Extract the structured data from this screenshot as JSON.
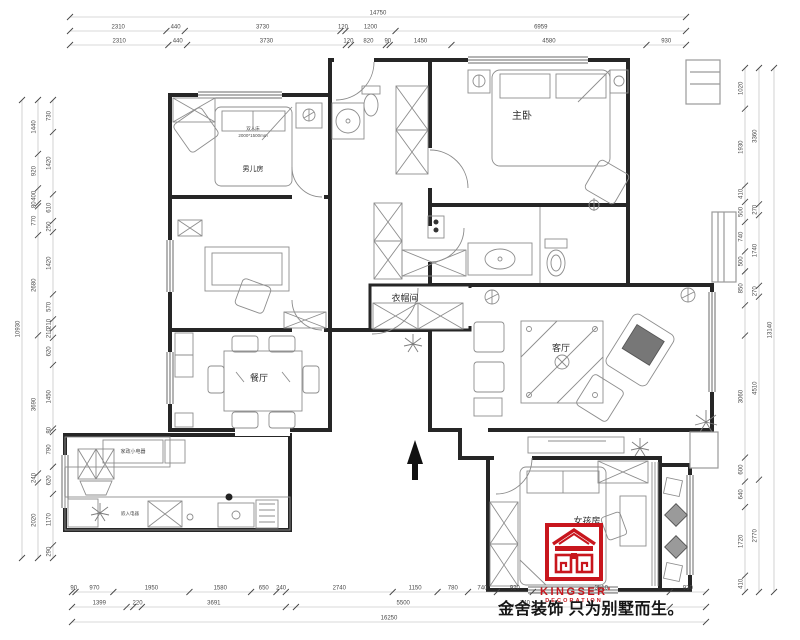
{
  "drawing_title": "apartment floor plan",
  "rooms": [
    {
      "name": "boys-room",
      "label": "男儿房",
      "x": 253,
      "y": 171,
      "size": 7
    },
    {
      "name": "master-bedroom",
      "label": "主卧",
      "x": 522,
      "y": 119,
      "size": 10
    },
    {
      "name": "cloakroom",
      "label": "衣帽间",
      "x": 405,
      "y": 301,
      "size": 9
    },
    {
      "name": "dining-room",
      "label": "餐厅",
      "x": 259,
      "y": 381,
      "size": 9
    },
    {
      "name": "living-room",
      "label": "客厅",
      "x": 561,
      "y": 351,
      "size": 9
    },
    {
      "name": "girls-room",
      "label": "女孩房",
      "x": 587,
      "y": 524,
      "size": 9
    }
  ],
  "annotations": [
    {
      "name": "bed-type-label",
      "label": "双人床",
      "x": 253,
      "y": 130,
      "size": 4.5
    },
    {
      "name": "bed-size-label",
      "label": "2000*1500mm",
      "x": 253,
      "y": 137,
      "size": 4.5
    },
    {
      "name": "kitchen-appliance-label",
      "label": "家政小电器",
      "x": 133,
      "y": 453,
      "size": 5
    },
    {
      "name": "built-in-appliance-label",
      "label": "嵌入电器",
      "x": 130,
      "y": 515,
      "size": 4.5
    }
  ],
  "dimensions": {
    "rows": [
      {
        "name": "top-total",
        "side": "top",
        "pos": 17,
        "from": 70,
        "to": 686,
        "segs": [
          [
            14750,
            "14750"
          ]
        ]
      },
      {
        "name": "top-row-2",
        "side": "top",
        "pos": 31,
        "from": 70,
        "to": 686,
        "segs": [
          [
            2310,
            "2310"
          ],
          [
            440,
            "440"
          ],
          [
            3730,
            "3730"
          ],
          [
            120,
            "120"
          ],
          [
            1200,
            "1200"
          ],
          [
            6959,
            "6959"
          ]
        ]
      },
      {
        "name": "top-row-3",
        "side": "top",
        "pos": 45,
        "from": 70,
        "to": 686,
        "segs": [
          [
            2310,
            "2310"
          ],
          [
            440,
            "440"
          ],
          [
            3730,
            "3730"
          ],
          [
            120,
            "120"
          ],
          [
            820,
            "820"
          ],
          [
            90,
            "90"
          ],
          [
            1450,
            "1450"
          ],
          [
            4580,
            "4580"
          ],
          [
            930,
            "930"
          ]
        ]
      },
      {
        "name": "bottom-row-1",
        "side": "bottom",
        "pos": 592,
        "from": 72,
        "to": 706,
        "segs": [
          [
            90,
            "90"
          ],
          [
            970,
            "970"
          ],
          [
            1950,
            "1950"
          ],
          [
            1580,
            "1580"
          ],
          [
            650,
            "650"
          ],
          [
            240,
            "240"
          ],
          [
            2740,
            "2740"
          ],
          [
            1150,
            "1150"
          ],
          [
            780,
            "780"
          ],
          [
            740,
            "740"
          ],
          [
            920,
            "920"
          ],
          [
            3510,
            "3510"
          ],
          [
            930,
            "930"
          ]
        ]
      },
      {
        "name": "bottom-row-2",
        "side": "bottom",
        "pos": 607,
        "from": 72,
        "to": 706,
        "segs": [
          [
            1399,
            "1399"
          ],
          [
            171,
            ""
          ],
          [
            220,
            "220"
          ],
          [
            3691,
            "3691"
          ],
          [
            259,
            ""
          ],
          [
            5500,
            "5500"
          ],
          [
            740,
            "740"
          ],
          [
            3340,
            ""
          ],
          [
            930,
            ""
          ]
        ]
      },
      {
        "name": "bottom-total",
        "side": "bottom",
        "pos": 622,
        "from": 72,
        "to": 706,
        "segs": [
          [
            16250,
            "16250"
          ]
        ]
      },
      {
        "name": "left-total",
        "side": "left",
        "pos": 22,
        "from": 100,
        "to": 558,
        "segs": [
          [
            10930,
            "10930"
          ]
        ]
      },
      {
        "name": "left-row-2",
        "side": "left",
        "pos": 38,
        "from": 100,
        "to": 558,
        "segs": [
          [
            1440,
            "1440"
          ],
          [
            920,
            "920"
          ],
          [
            400,
            "400"
          ],
          [
            80,
            "80"
          ],
          [
            770,
            "770"
          ],
          [
            2680,
            "2680"
          ],
          [
            3690,
            "3690"
          ],
          [
            240,
            "240"
          ],
          [
            2020,
            "2020"
          ]
        ]
      },
      {
        "name": "left-row-3",
        "side": "left",
        "pos": 53,
        "from": 100,
        "to": 558,
        "segs": [
          [
            730,
            "730"
          ],
          [
            1420,
            "1420"
          ],
          [
            610,
            "610"
          ],
          [
            250,
            "250"
          ],
          [
            1420,
            "1420"
          ],
          [
            570,
            "570"
          ],
          [
            210,
            "210"
          ],
          [
            210,
            "210"
          ],
          [
            620,
            "620"
          ],
          [
            1450,
            "1450"
          ],
          [
            80,
            "80"
          ],
          [
            790,
            "790"
          ],
          [
            620,
            "620"
          ],
          [
            1170,
            "1170"
          ],
          [
            290,
            "290"
          ]
        ]
      },
      {
        "name": "right-total",
        "side": "right",
        "pos": 774,
        "from": 68,
        "to": 592,
        "segs": [
          [
            13140,
            "13140"
          ]
        ]
      },
      {
        "name": "right-row-2",
        "side": "right",
        "pos": 759,
        "from": 68,
        "to": 592,
        "segs": [
          [
            3360,
            "3360"
          ],
          [
            270,
            "270"
          ],
          [
            1740,
            "1740"
          ],
          [
            270,
            "270"
          ],
          [
            4510,
            "4510"
          ],
          [
            2770,
            "2770"
          ]
        ]
      },
      {
        "name": "right-row-3",
        "side": "right",
        "pos": 745,
        "from": 68,
        "to": 592,
        "segs": [
          [
            1020,
            "1020"
          ],
          [
            1930,
            "1930"
          ],
          [
            410,
            "410"
          ],
          [
            500,
            "500"
          ],
          [
            740,
            "740"
          ],
          [
            500,
            "500"
          ],
          [
            850,
            "850"
          ],
          [
            760,
            ""
          ],
          [
            3060,
            "3060"
          ],
          [
            600,
            "600"
          ],
          [
            640,
            "640"
          ],
          [
            1720,
            "1720"
          ],
          [
            410,
            "410"
          ]
        ]
      }
    ]
  },
  "logo": {
    "brand": "KINGSER'",
    "sub": "DECORATION",
    "color": "#c8161d"
  },
  "watermark": {
    "text": "金舍装饰 只为别墅而生。"
  },
  "colors": {
    "wall": "#262626",
    "furniture": "#8d8d8d",
    "dim_text": "#4a4a4a",
    "logo_red": "#c8161d"
  }
}
